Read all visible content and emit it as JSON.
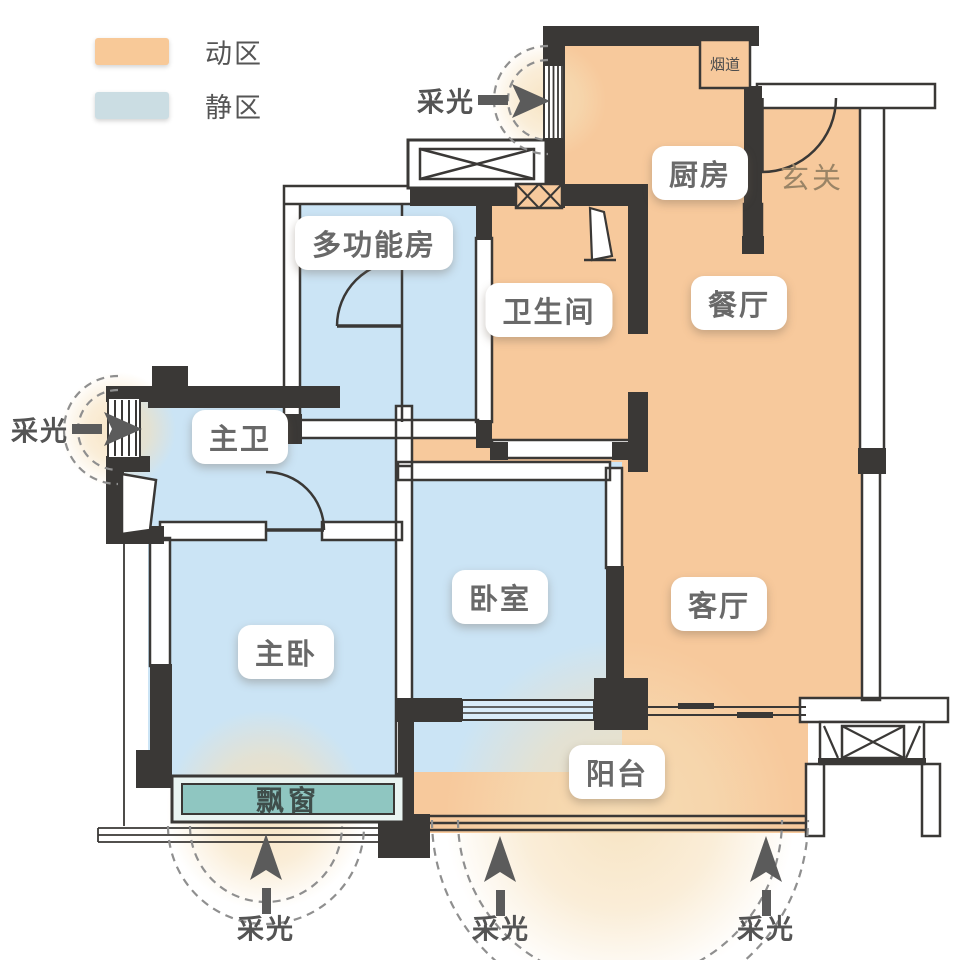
{
  "legend": {
    "active_label": "动区",
    "quiet_label": "静区"
  },
  "rooms": {
    "multi_function": "多功能房",
    "kitchen": "厨房",
    "hall": "玄关",
    "flue": "烟道",
    "dining": "餐厅",
    "bathroom": "卫生间",
    "master_bath": "主卫",
    "master_bed": "主卧",
    "bedroom": "卧室",
    "living": "客厅",
    "balcony": "阳台",
    "bay_window": "飘窗"
  },
  "daylight_label": "采光",
  "colors": {
    "active_zone": "#F7C99C",
    "quiet_zone": "#CBE4F5",
    "legend_active": "#F8C998",
    "legend_quiet": "#CBDDE3",
    "bay_window": "#8FC6C1",
    "bay_frame": "#E9F4F2",
    "wall": "#3A3836",
    "glow": "#F6DFB8",
    "arrow": "#5B5B5B"
  }
}
